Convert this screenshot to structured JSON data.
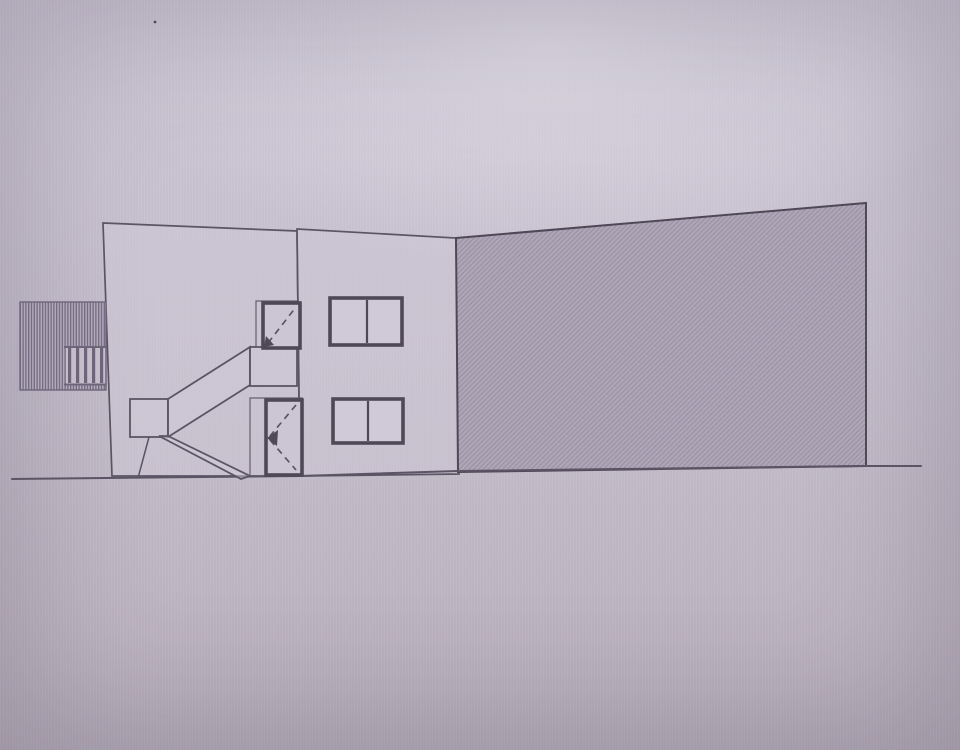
{
  "meta": {
    "type": "architectural side elevation drawing (photo of screen)",
    "visible_text": ""
  },
  "colors": {
    "line": "#5a5464",
    "line_dark": "#4e4857",
    "wall_fill": "#cfc9d780",
    "hatch_bg": "#aea6b7",
    "hatch_line": "#8b8396",
    "louver_bg": "#b2aabb",
    "louver_line": "#6d667a",
    "panel_fill": "#c5beca",
    "window_fill": "#d0cad8",
    "door_fill": "#ccc6d4",
    "background_top": "#cbc5d4",
    "background_bottom": "#b6aebb"
  },
  "drawing": {
    "elements": [
      {
        "name": "facade-left",
        "type": "polygon",
        "class": "wall",
        "attrs": {
          "points": "103,223 297,231 300,476 112,476"
        }
      },
      {
        "name": "facade-right",
        "type": "polygon",
        "class": "wall",
        "attrs": {
          "points": "297,229 456,238 459,474 300,476"
        }
      },
      {
        "name": "hatched-wall",
        "type": "polygon",
        "class": "hatch",
        "attrs": {
          "points": "456,238 866,203 866,466 458,472"
        }
      },
      {
        "name": "ground-line",
        "type": "polyline",
        "class": "ground",
        "attrs": {
          "points": "12,479 300,476 458,471 864,466 921,466"
        }
      },
      {
        "name": "louver-screen",
        "type": "rect",
        "class": "louver",
        "attrs": {
          "x": "20",
          "y": "302",
          "width": "86",
          "height": "88"
        }
      },
      {
        "name": "louver-panel",
        "type": "rect",
        "class": "louver-panel",
        "attrs": {
          "x": "66",
          "y": "348",
          "width": "39",
          "height": "36"
        }
      },
      {
        "name": "louver-bar",
        "type": "rect",
        "class": "bar",
        "attrs": {
          "x": "68",
          "y": "348",
          "width": "3.2",
          "height": "35"
        }
      },
      {
        "name": "louver-bar",
        "type": "rect",
        "class": "bar",
        "attrs": {
          "x": "76",
          "y": "348",
          "width": "3.2",
          "height": "35"
        }
      },
      {
        "name": "louver-bar",
        "type": "rect",
        "class": "bar",
        "attrs": {
          "x": "84",
          "y": "348",
          "width": "3.2",
          "height": "35"
        }
      },
      {
        "name": "louver-bar",
        "type": "rect",
        "class": "bar",
        "attrs": {
          "x": "92",
          "y": "348",
          "width": "3.2",
          "height": "35"
        }
      },
      {
        "name": "louver-bar",
        "type": "rect",
        "class": "bar",
        "attrs": {
          "x": "100",
          "y": "348",
          "width": "3.2",
          "height": "35"
        }
      },
      {
        "name": "louver-rail-top",
        "type": "line",
        "class": "rail",
        "attrs": {
          "x1": "64",
          "y1": "347",
          "x2": "106",
          "y2": "347"
        }
      },
      {
        "name": "louver-rail-bottom",
        "type": "line",
        "class": "rail",
        "attrs": {
          "x1": "64",
          "y1": "384.5",
          "x2": "106",
          "y2": "384.5"
        }
      },
      {
        "name": "stair-platform",
        "type": "rect",
        "class": "wall2",
        "attrs": {
          "x": "130",
          "y": "399",
          "width": "38",
          "height": "38"
        }
      },
      {
        "name": "stair-upper-flight",
        "type": "polygon",
        "class": "wall2",
        "attrs": {
          "points": "168,399 250,347 250,385 168,437"
        }
      },
      {
        "name": "stair-landing",
        "type": "rect",
        "class": "wall2",
        "attrs": {
          "x": "250",
          "y": "347",
          "width": "47",
          "height": "39"
        }
      },
      {
        "name": "stair-lower-flight",
        "type": "polygon",
        "class": "wall2",
        "attrs": {
          "points": "159,436 168,436 250,476 241,479"
        }
      },
      {
        "name": "stair-support",
        "type": "line",
        "class": "stroke15",
        "attrs": {
          "x1": "149",
          "y1": "437",
          "x2": "138",
          "y2": "478"
        }
      },
      {
        "name": "door-reveal-upper",
        "type": "polyline",
        "class": "thin",
        "attrs": {
          "points": "256,347 256,301 299,301"
        }
      },
      {
        "name": "door-reveal-lower",
        "type": "polyline",
        "class": "thin",
        "attrs": {
          "points": "250,476 250,398 303,398"
        }
      },
      {
        "name": "door-upper",
        "type": "rect",
        "class": "frame",
        "attrs": {
          "x": "263",
          "y": "303",
          "width": "37",
          "height": "45"
        }
      },
      {
        "name": "door-upper-swing-dash",
        "type": "line",
        "class": "dash",
        "attrs": {
          "x1": "268",
          "y1": "343",
          "x2": "296",
          "y2": "307"
        }
      },
      {
        "name": "door-upper-swing-arrow",
        "type": "polygon",
        "class": "solid",
        "attrs": {
          "points": "264,347 266,336 274,345"
        }
      },
      {
        "name": "door-lower",
        "type": "rect",
        "class": "frame",
        "attrs": {
          "x": "266",
          "y": "400",
          "width": "36",
          "height": "75"
        }
      },
      {
        "name": "door-lower-swing-dash-upper",
        "type": "line",
        "class": "dash",
        "attrs": {
          "x1": "296",
          "y1": "405",
          "x2": "270",
          "y2": "436"
        }
      },
      {
        "name": "door-lower-swing-dash-lower",
        "type": "line",
        "class": "dash",
        "attrs": {
          "x1": "270",
          "y1": "440",
          "x2": "296",
          "y2": "470"
        }
      },
      {
        "name": "door-lower-swing-arrow",
        "type": "polygon",
        "class": "solid",
        "attrs": {
          "points": "267,438 278,430 277,446"
        }
      },
      {
        "name": "window-upper",
        "type": "rect",
        "class": "frame2",
        "attrs": {
          "x": "330",
          "y": "298",
          "width": "72",
          "height": "47"
        }
      },
      {
        "name": "window-upper-mullion",
        "type": "line",
        "class": "mullion",
        "attrs": {
          "x1": "367",
          "y1": "300",
          "x2": "367",
          "y2": "343"
        }
      },
      {
        "name": "window-lower",
        "type": "rect",
        "class": "frame2",
        "attrs": {
          "x": "333",
          "y": "399",
          "width": "70",
          "height": "44"
        }
      },
      {
        "name": "window-lower-mullion",
        "type": "line",
        "class": "mullion",
        "attrs": {
          "x1": "368",
          "y1": "401",
          "x2": "368",
          "y2": "441"
        }
      },
      {
        "name": "dust-speck",
        "type": "circle",
        "class": "solid",
        "attrs": {
          "cx": "155",
          "cy": "22",
          "r": "1.4"
        }
      }
    ]
  }
}
